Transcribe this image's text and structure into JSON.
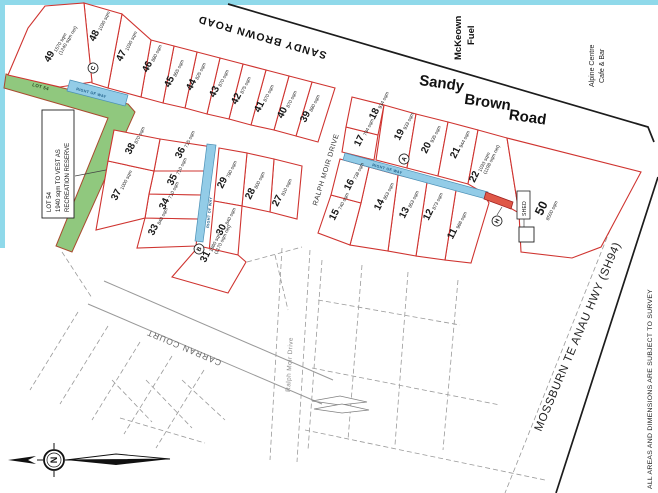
{
  "map": {
    "colors": {
      "lot_line": "#cf3430",
      "lot_fill": "#ffffff",
      "reserve_fill": "#90c87e",
      "reserve_stroke": "#a84b2f",
      "row_fill": "#93cce7",
      "row_stroke": "#4a8fb5",
      "red_strip_fill": "#df5848",
      "red_strip_stroke": "#a02020",
      "road_line": "#1c1c1c",
      "dashed_line": "#9a9a9a",
      "gray_road": "#999999",
      "page_border": "#8fd9ea"
    },
    "labels": {
      "sandy_brown_top": "SANDY BROWN ROAD",
      "sandy": "Sandy",
      "brown": "Brown",
      "road": "Road",
      "mckeown1": "McKeown",
      "mckeown2": "Fuel",
      "alpine1": "Alpine  Centre",
      "alpine2": "Cafe & Bar",
      "mossburn": "MOSSBURN TE ANAU HWY (SH94)",
      "ralph_upper": "RALPH MOIR DRIVE",
      "ralph_lower": "Ralph Moir Drive",
      "carran": "CARRAN COURT",
      "disclaimer": "ALL AREAS AND DIMENSIONS ARE SUBJECT TO SURVEY",
      "row": "RIGHT OF WAY",
      "reserve_strip": "LOT 54",
      "reserve_box": [
        "LOT 54",
        "1940 sqm TO VEST AS",
        "RECREATION RESERVE"
      ],
      "shed": "SHED",
      "north": "N"
    },
    "reserve_pts": "6,74 128,104 135,112 72,252 56,246 108,118 4,88",
    "reserve_label_pos": {
      "x": 32,
      "y": 86,
      "r": 15
    },
    "reserve_box_rect": [
      42,
      110,
      32,
      108
    ],
    "reserve_leader": "75,176 106,170",
    "strips": [
      {
        "name": "row-upper-left",
        "pts": "70,80 128,95 125,106 67,91",
        "label": {
          "x": 76,
          "y": 90,
          "r": 15
        }
      },
      {
        "name": "row-middle",
        "pts": "345,153 488,192 486,199 343,160",
        "label": {
          "x": 372,
          "y": 166,
          "r": 15.3
        }
      },
      {
        "name": "row-vertical",
        "pts": "207,144 216,145 203,242 195,241",
        "label": {
          "x": 209,
          "y": 228,
          "r": -84
        }
      }
    ],
    "red_strip_pts": "486,192 513,202 511,209 484,199",
    "black_lines": [
      "228,4 648,127 654,142",
      "658,177 556,493"
    ],
    "gray_road_lines": [
      "104,281 333,380",
      "88,304 322,404"
    ],
    "dashed_lines": [
      "78,312 30,390",
      "108,326 60,404",
      "140,342 92,420",
      "172,356 124,434",
      "204,370 156,448",
      "62,252 92,298",
      "112,380 152,422",
      "146,380 192,428",
      "182,380 225,420",
      "120,418 205,443",
      "282,248 270,460",
      "310,250 297,462",
      "322,260 308,450",
      "362,265 348,440",
      "408,272 395,445",
      "458,280 443,450",
      "318,300 460,325",
      "312,368 500,405",
      "305,430 545,480",
      "622,200 505,493",
      "247,262 302,247",
      "275,255 288,310"
    ],
    "lens_shapes": [
      "312,401 340,396 367,402 340,405",
      "314,409 342,404 369,410 342,413"
    ],
    "markers": [
      {
        "t": "A",
        "x": 404,
        "y": 159
      },
      {
        "t": "B",
        "x": 199,
        "y": 249
      },
      {
        "t": "C",
        "x": 93,
        "y": 68
      },
      {
        "t": "H",
        "x": 497,
        "y": 221
      }
    ],
    "h_leader": "497,215 502,207",
    "shed": {
      "label_box": [
        517,
        191,
        13,
        28
      ],
      "building": [
        519,
        227,
        15,
        15
      ],
      "leader": "524,219 524,227"
    },
    "lots": [
      {
        "n": "11",
        "a": "966 sqm",
        "lx": 455,
        "ly": 235,
        "pts": "456,190 486,198 489,203 471,263 445,260"
      },
      {
        "n": "12",
        "a": "873 sqm",
        "lx": 431,
        "ly": 216,
        "pts": "427,182 456,190 445,260 416,256"
      },
      {
        "n": "13",
        "a": "853 sqm",
        "lx": 407,
        "ly": 214,
        "pts": "398,175 427,182 416,256 388,251"
      },
      {
        "n": "14",
        "a": "853 sqm",
        "lx": 382,
        "ly": 206,
        "pts": "369,167 398,175 388,251 350,245 361,203"
      },
      {
        "n": "15",
        "a": "740 sqm",
        "lx": 337,
        "ly": 216,
        "pts": "331,195 361,203 350,245 318,233"
      },
      {
        "n": "16",
        "a": "738 sqm",
        "lx": 352,
        "ly": 186,
        "pts": "340,159 369,167 361,203 331,195"
      },
      {
        "n": "17",
        "a": "794 sqm",
        "lx": 362,
        "ly": 142,
        "pts": "346,127 378,135 374,160 342,152"
      },
      {
        "n": "18",
        "a": "934 sqm",
        "lx": 377,
        "ly": 115,
        "pts": "352,97 384,105 378,135 346,127"
      },
      {
        "n": "19",
        "a": "933 sqm",
        "lx": 402,
        "ly": 136,
        "pts": "384,105 416,114 407,168 376,160"
      },
      {
        "n": "20",
        "a": "935 sqm",
        "lx": 429,
        "ly": 149,
        "pts": "416,114 448,122 438,176 407,168"
      },
      {
        "n": "21",
        "a": "944 sqm",
        "lx": 458,
        "ly": 154,
        "pts": "448,122 478,130 468,184 438,176"
      },
      {
        "n": "22",
        "a": "1033 sqm",
        "net": "(1198 sqm net)",
        "lx": 477,
        "ly": 178,
        "pts": "478,130 507,138 519,213 489,196 468,184"
      },
      {
        "n": "27",
        "a": "810 sqm",
        "lx": 280,
        "ly": 202,
        "pts": "274,159 302,166 297,219 270,212"
      },
      {
        "n": "28",
        "a": "800 sqm",
        "lx": 253,
        "ly": 195,
        "pts": "247,153 274,159 270,212 242,206"
      },
      {
        "n": "29",
        "a": "780 sqm",
        "lx": 225,
        "ly": 184,
        "pts": "219,148 247,153 242,206 214,201"
      },
      {
        "n": "30",
        "a": "840 sqm",
        "lx": 224,
        "ly": 231,
        "pts": "214,201 242,206 238,255 209,252"
      },
      {
        "n": "31",
        "a": "1660 sqm",
        "net": "(1170 sqm net)",
        "lx": 208,
        "ly": 258,
        "pts": "199,246 238,255 246,262 228,293 172,277"
      },
      {
        "n": "33",
        "a": "840 sqm",
        "lx": 156,
        "ly": 231,
        "pts": "145,218 199,219 196,246 137,248"
      },
      {
        "n": "34",
        "a": "710 sqm",
        "lx": 167,
        "ly": 205,
        "pts": "149,194 203,195 199,219 145,218"
      },
      {
        "n": "35",
        "a": "710 sqm",
        "lx": 175,
        "ly": 181,
        "pts": "154,171 207,171 203,195 149,194"
      },
      {
        "n": "36",
        "a": "715 sqm",
        "lx": 183,
        "ly": 154,
        "pts": "160,139 212,147 207,171 154,171"
      },
      {
        "n": "37",
        "a": "1000 sqm",
        "lx": 119,
        "ly": 196,
        "pts": "108,161 154,171 149,194 145,218 96,230"
      },
      {
        "n": "38",
        "a": "870 sqm",
        "lx": 133,
        "ly": 150,
        "pts": "114,130 160,139 154,171 108,161"
      },
      {
        "n": "39",
        "a": "880 sqm",
        "lx": 308,
        "ly": 118,
        "pts": "312,82 335,88 318,142 296,136"
      },
      {
        "n": "40",
        "a": "870 sqm",
        "lx": 285,
        "ly": 114,
        "pts": "289,76 312,82 296,136 274,130"
      },
      {
        "n": "41",
        "a": "870 sqm",
        "lx": 262,
        "ly": 108,
        "pts": "266,70 289,76 274,130 251,125"
      },
      {
        "n": "42",
        "a": "875 sqm",
        "lx": 239,
        "ly": 100,
        "pts": "243,64 266,70 251,125 229,119"
      },
      {
        "n": "43",
        "a": "870 sqm",
        "lx": 217,
        "ly": 93,
        "pts": "220,58 243,64 229,119 207,114"
      },
      {
        "n": "44",
        "a": "825 sqm",
        "lx": 194,
        "ly": 86,
        "pts": "197,52 220,58 207,114 185,108"
      },
      {
        "n": "45",
        "a": "855 sqm",
        "lx": 172,
        "ly": 83,
        "pts": "174,46 197,52 185,108 163,103"
      },
      {
        "n": "46",
        "a": "880 sqm",
        "lx": 150,
        "ly": 68,
        "pts": "151,40 174,46 163,103 141,97"
      },
      {
        "n": "47",
        "a": "1030 sqm",
        "lx": 124,
        "ly": 57,
        "pts": "122,14 151,40 141,97 108,88"
      },
      {
        "n": "48",
        "a": "1030 sqm",
        "lx": 97,
        "ly": 37,
        "pts": "84,3 122,14 108,88 92,83"
      },
      {
        "n": "49",
        "a": "1570 sqm",
        "net": "(1240 sqm net)",
        "lx": 52,
        "ly": 58,
        "r": -60,
        "pts": "45,6 84,3 92,82 60,87 8,75 28,28"
      },
      {
        "n": "50",
        "a": "8500 sqm",
        "big": true,
        "below": true,
        "lx": 545,
        "ly": 210,
        "pts": "507,138 641,172 601,247 572,258 521,252 519,213"
      }
    ]
  }
}
